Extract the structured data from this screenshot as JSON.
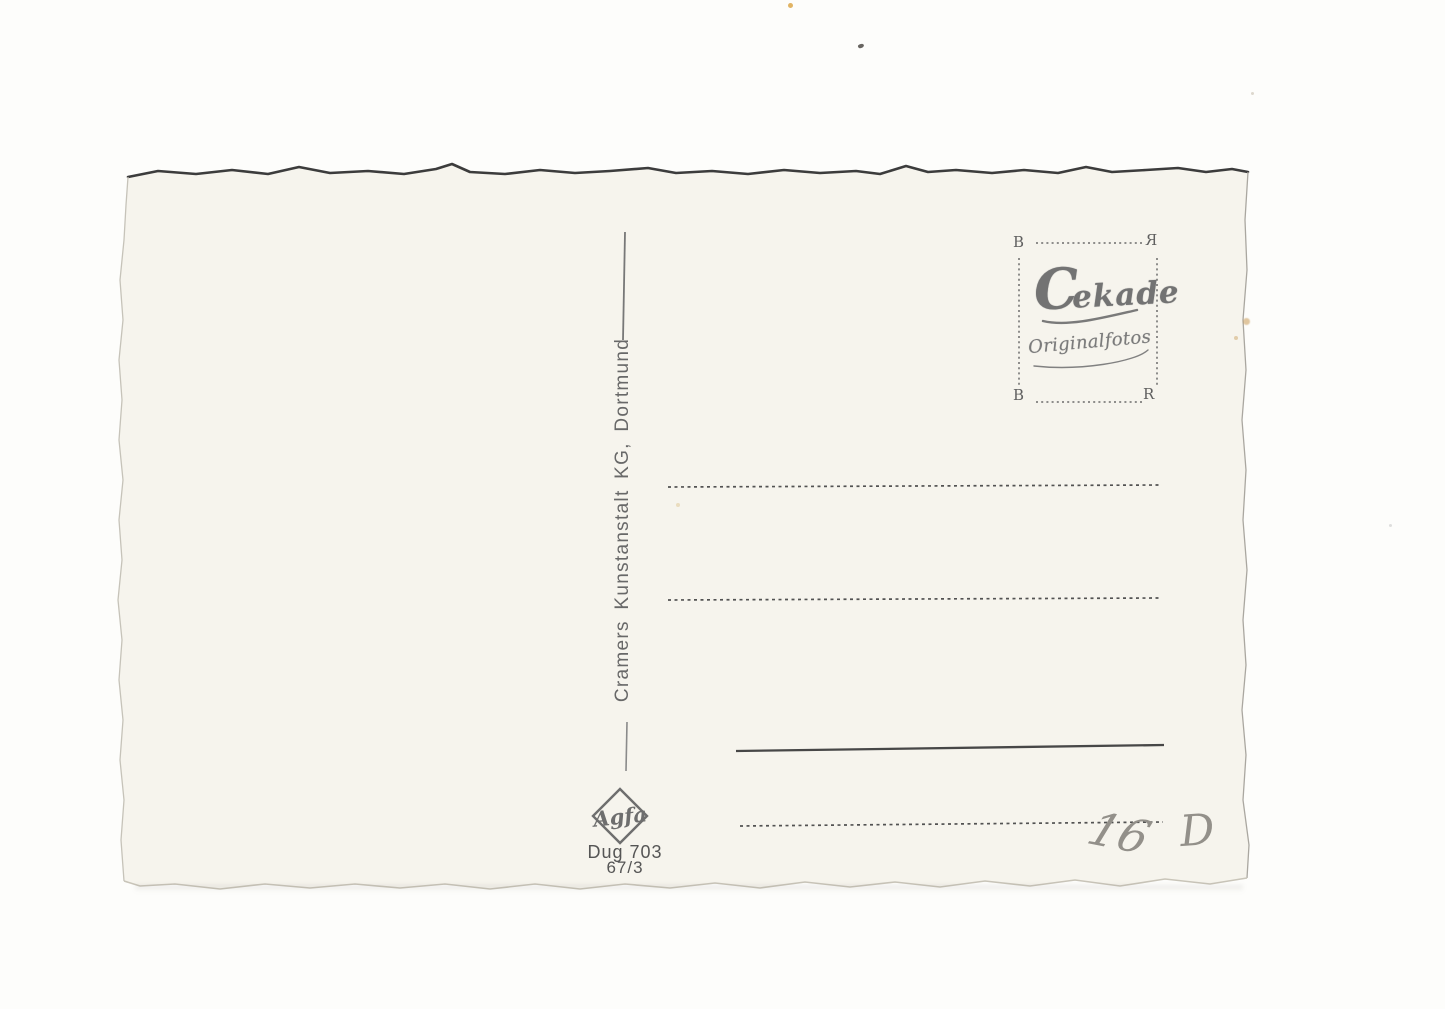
{
  "scene": {
    "description": "Scan of the blank back of a vintage Cekade real-photo postcard",
    "background_color": "#fdfdfb",
    "card_color": "#f6f4ed"
  },
  "postcard": {
    "publisher_line": "Cramers Kunstanstalt KG, Dortmund",
    "stamp_box": {
      "corners": {
        "top_left": "B",
        "top_right": "R",
        "bottom_left": "B",
        "bottom_right": "R"
      },
      "brand": "Cekade",
      "brand_initial": "C",
      "brand_rest": "ekade",
      "subtitle": "Originalfotos"
    },
    "film_logo": "Agfa",
    "print_code_line1": "Dug 703",
    "print_code_line2": "67/3",
    "handwriting": {
      "number": "16",
      "letter": "D"
    }
  },
  "colors": {
    "ink": "#555555",
    "stamp_ink": "#757575",
    "pencil": "#93908a",
    "top_edge_shadow": "#3c3c3c"
  }
}
